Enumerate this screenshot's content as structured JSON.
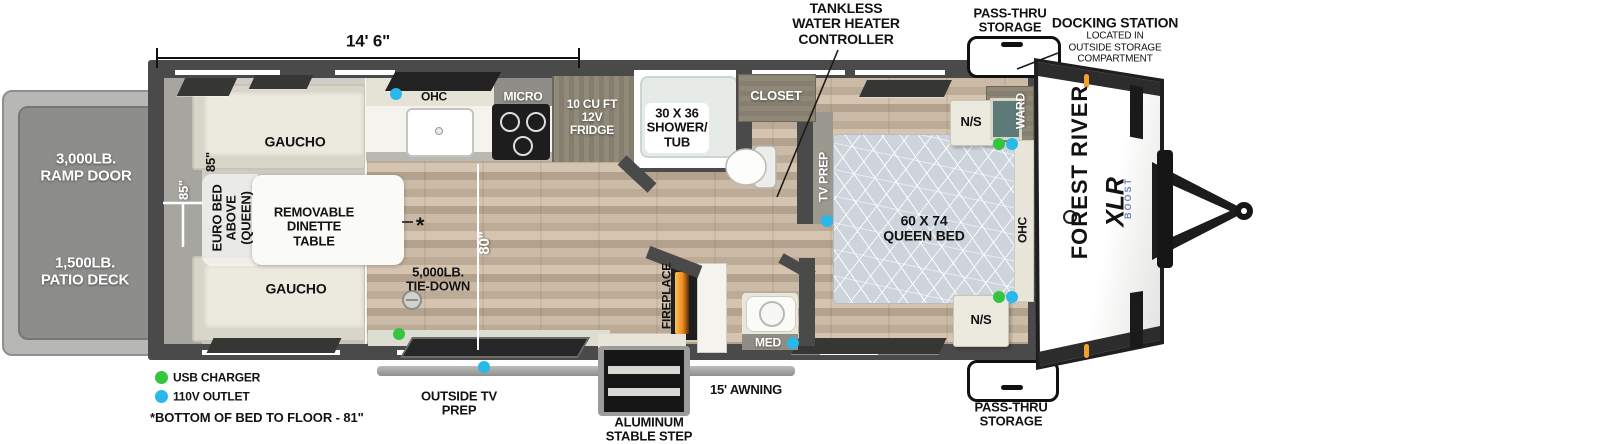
{
  "dimensions": {
    "overall_length": "14' 6\"",
    "bed_height_black": "85\"",
    "bed_height_white": "85\"",
    "garage_width": "80\"",
    "footnote": "*BOTTOM OF BED TO FLOOR - 81\""
  },
  "legend": {
    "usb": "USB CHARGER",
    "outlet": "110V OUTLET"
  },
  "exterior": {
    "ramp_door": [
      "3,000LB.",
      "RAMP DOOR"
    ],
    "patio_deck": [
      "1,500LB.",
      "PATIO DECK"
    ],
    "awning": "15' AWNING",
    "outside_tv": [
      "OUTSIDE TV",
      "PREP"
    ],
    "step": [
      "ALUMINUM",
      "STABLE STEP"
    ],
    "pass_thru_top": [
      "PASS-THRU",
      "STORAGE"
    ],
    "pass_thru_bottom": [
      "PASS-THRU",
      "STORAGE"
    ],
    "docking": [
      "DOCKING STATION",
      "LOCATED IN",
      "OUTSIDE STORAGE",
      "COMPARTMENT"
    ],
    "tankless": [
      "TANKLESS",
      "WATER HEATER",
      "CONTROLLER"
    ]
  },
  "interior": {
    "gaucho_top": "GAUCHO",
    "gaucho_bottom": "GAUCHO",
    "euro_bed": [
      "EURO BED",
      "ABOVE",
      "(QUEEN)"
    ],
    "dinette": [
      "REMOVABLE",
      "DINETTE",
      "TABLE"
    ],
    "asterisk": "*",
    "tie_down": [
      "5,000LB.",
      "TIE-DOWN"
    ],
    "ohc_kitchen": "OHC",
    "micro": "MICRO",
    "fridge": [
      "10 CU FT",
      "12V",
      "FRIDGE"
    ],
    "shower": [
      "30 X 36",
      "SHOWER/",
      "TUB"
    ],
    "closet": "CLOSET",
    "tv_prep": "TV PREP",
    "queen_bed": [
      "60 X 74",
      "QUEEN BED"
    ],
    "ns_top": "N/S",
    "ns_bottom": "N/S",
    "ward": "WARD",
    "ohc_bedroom": "OHC",
    "med": "MED",
    "fireplace": "FIREPLACE"
  },
  "brand": {
    "forest_river": "FOREST RIVER",
    "model": "XLR",
    "submodel": "BOOST"
  },
  "colors": {
    "usb_green": "#35c53f",
    "outlet_blue": "#2ab8ea",
    "clearance_orange": "#f0a22e",
    "wall": "#4a4a4b"
  }
}
